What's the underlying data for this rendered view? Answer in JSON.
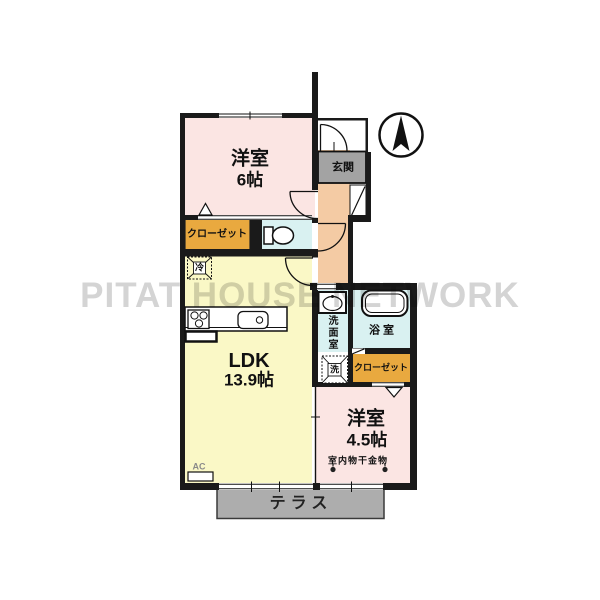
{
  "watermark": "PITAT HOUSE NETWORK",
  "rooms": {
    "bedroom6": {
      "name": "洋室",
      "size": "6帖"
    },
    "ldk": {
      "name": "LDK",
      "size": "13.9帖"
    },
    "bedroom45": {
      "name": "洋室",
      "size": "4.5帖"
    },
    "entrance": {
      "label": "玄関"
    },
    "washroom": {
      "label": "洗面室"
    },
    "bathroom": {
      "label": "浴室"
    },
    "closet_north": {
      "label": "クローゼット"
    },
    "closet_south": {
      "label": "クローゼット"
    },
    "terrace": {
      "label": "テラス"
    }
  },
  "annotations": {
    "ac_unit": "AC",
    "indoor_laundry": "室内物干金物",
    "refrigerator": "冷",
    "washer": "洗"
  },
  "icons": {
    "compass": "north-arrow",
    "toilet": "toilet-icon",
    "bathtub": "bathtub-icon",
    "basin": "washbasin-icon",
    "stove": "stove-icon",
    "sink": "kitchen-sink-icon"
  },
  "colors": {
    "room_pink": "#FBE5E3",
    "room_yellow": "#FAF8C6",
    "room_cyan": "#D9F1F1",
    "closet_orange": "#E9A93F",
    "hallway_peach": "#F4CBA4",
    "entrance_gray": "#A3A3A3",
    "terrace_gray": "#ADADAD",
    "wall": "#1A1A1A",
    "watermark_gray": "#D4D4D4"
  }
}
